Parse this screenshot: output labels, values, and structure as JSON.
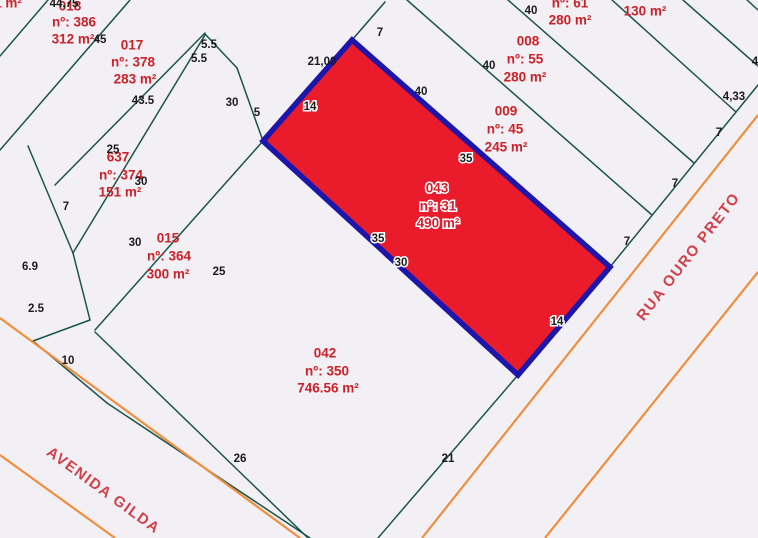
{
  "map": {
    "width": 758,
    "height": 538,
    "background": "#f2eff5",
    "colors": {
      "boundary_green": "#1a5547",
      "street_orange": "#ef8f3d",
      "highlight_fill": "#ea1c2c",
      "highlight_border": "#1c16aa",
      "parcel_label_red": "#cc2127",
      "street_name_red": "#d23f48",
      "dimension_black": "#1b1b1b",
      "halo_white": "#ffffff"
    },
    "highlight_parcel": {
      "id": "043",
      "numero": "nº: 31",
      "area": "490 m²",
      "vertices": "352,40 610,267 518,375 263,141",
      "labels": [
        {
          "text": "043",
          "x": 437,
          "y": 189
        },
        {
          "text": "nº: 31",
          "x": 438,
          "y": 207
        },
        {
          "text": "490 m²",
          "x": 438,
          "y": 224
        }
      ]
    },
    "parcels": [
      {
        "name": "parcel-018",
        "lines": [
          {
            "text": "018",
            "x": 70,
            "y": 7
          },
          {
            "text": "nº: 386",
            "x": 74,
            "y": 23
          },
          {
            "text": "312 m²",
            "x": 73,
            "y": 40
          }
        ]
      },
      {
        "name": "parcel-017",
        "lines": [
          {
            "text": "017",
            "x": 132,
            "y": 46
          },
          {
            "text": "nº: 378",
            "x": 133,
            "y": 63
          },
          {
            "text": "283 m²",
            "x": 135,
            "y": 80
          }
        ]
      },
      {
        "name": "parcel-637",
        "lines": [
          {
            "text": "637",
            "x": 118,
            "y": 158
          },
          {
            "text": "nº: 374",
            "x": 121,
            "y": 176
          },
          {
            "text": "151 m²",
            "x": 120,
            "y": 193
          }
        ]
      },
      {
        "name": "parcel-015",
        "lines": [
          {
            "text": "015",
            "x": 168,
            "y": 239
          },
          {
            "text": "nº: 364",
            "x": 169,
            "y": 257
          },
          {
            "text": "300 m²",
            "x": 168,
            "y": 275
          }
        ]
      },
      {
        "name": "parcel-042",
        "lines": [
          {
            "text": "042",
            "x": 325,
            "y": 354
          },
          {
            "text": "nº: 350",
            "x": 327,
            "y": 372
          },
          {
            "text": "746.56 m²",
            "x": 328,
            "y": 389
          }
        ]
      },
      {
        "name": "parcel-008",
        "lines": [
          {
            "text": "008",
            "x": 528,
            "y": 42
          },
          {
            "text": "nº: 55",
            "x": 525,
            "y": 60
          },
          {
            "text": "280 m²",
            "x": 525,
            "y": 78
          }
        ]
      },
      {
        "name": "parcel-009",
        "lines": [
          {
            "text": "009",
            "x": 506,
            "y": 112
          },
          {
            "text": "nº: 45",
            "x": 505,
            "y": 130
          },
          {
            "text": "245 m²",
            "x": 506,
            "y": 148
          }
        ]
      },
      {
        "name": "parcel-61",
        "lines": [
          {
            "text": "nº: 61",
            "x": 570,
            "y": 4
          },
          {
            "text": "280 m²",
            "x": 570,
            "y": 21
          }
        ]
      },
      {
        "name": "parcel-130",
        "lines": [
          {
            "text": "130 m²",
            "x": 645,
            "y": 12
          }
        ]
      },
      {
        "name": "parcel-edge-partial",
        "lines": [
          {
            "text": "1 m²",
            "x": 8,
            "y": 4
          }
        ]
      }
    ],
    "dimensions": [
      {
        "text": "44,75",
        "x": 64,
        "y": 4
      },
      {
        "text": "45",
        "x": 100,
        "y": 40
      },
      {
        "text": "5.5",
        "x": 209,
        "y": 45
      },
      {
        "text": "5.5",
        "x": 199,
        "y": 59
      },
      {
        "text": "43.5",
        "x": 143,
        "y": 101
      },
      {
        "text": "30",
        "x": 232,
        "y": 103
      },
      {
        "text": "5",
        "x": 257,
        "y": 113
      },
      {
        "text": "25",
        "x": 113,
        "y": 150
      },
      {
        "text": "30",
        "x": 141,
        "y": 182
      },
      {
        "text": "7",
        "x": 66,
        "y": 207
      },
      {
        "text": "30",
        "x": 135,
        "y": 243
      },
      {
        "text": "25",
        "x": 219,
        "y": 272
      },
      {
        "text": "6.9",
        "x": 30,
        "y": 267
      },
      {
        "text": "2.5",
        "x": 36,
        "y": 309
      },
      {
        "text": "10",
        "x": 68,
        "y": 361
      },
      {
        "text": "26",
        "x": 240,
        "y": 459
      },
      {
        "text": "21",
        "x": 448,
        "y": 459
      },
      {
        "text": "21,00",
        "x": 322,
        "y": 62
      },
      {
        "text": "7",
        "x": 380,
        "y": 33
      },
      {
        "text": "40",
        "x": 421,
        "y": 92
      },
      {
        "text": "40",
        "x": 489,
        "y": 66
      },
      {
        "text": "40",
        "x": 531,
        "y": 11
      },
      {
        "text": "7",
        "x": 627,
        "y": 242
      },
      {
        "text": "7",
        "x": 675,
        "y": 184
      },
      {
        "text": "7",
        "x": 719,
        "y": 133
      },
      {
        "text": "4,33",
        "x": 734,
        "y": 97
      },
      {
        "text": "4",
        "x": 755,
        "y": 62
      },
      {
        "text": "14",
        "x": 310,
        "y": 107,
        "halo": true
      },
      {
        "text": "35",
        "x": 466,
        "y": 159,
        "halo": true
      },
      {
        "text": "35",
        "x": 378,
        "y": 239,
        "halo": true
      },
      {
        "text": "30",
        "x": 401,
        "y": 263,
        "halo": true
      },
      {
        "text": "14",
        "x": 557,
        "y": 322,
        "halo": true
      }
    ],
    "streets": [
      {
        "name": "AVENIDA GILDA",
        "x": 103,
        "y": 491,
        "angle": 36
      },
      {
        "name": "RUA OURO PRETO",
        "x": 689,
        "y": 257,
        "angle": -52
      }
    ],
    "boundary_lines": [
      [
        0,
        56,
        48,
        0
      ],
      [
        0,
        150,
        130,
        0
      ],
      [
        55,
        185,
        205,
        33
      ],
      [
        73,
        253,
        205,
        35
      ],
      [
        95,
        330,
        263,
        141
      ],
      [
        28,
        146,
        73,
        253
      ],
      [
        73,
        253,
        90,
        320
      ],
      [
        90,
        320,
        33,
        341
      ],
      [
        205,
        34,
        237,
        68
      ],
      [
        237,
        68,
        263,
        141
      ],
      [
        33,
        341,
        107,
        403
      ],
      [
        107,
        403,
        310,
        538
      ],
      [
        95,
        332,
        308,
        538
      ],
      [
        518,
        375,
        378,
        538
      ],
      [
        610,
        267,
        758,
        85
      ],
      [
        407,
        0,
        652,
        215
      ],
      [
        508,
        0,
        694,
        163
      ],
      [
        612,
        0,
        736,
        112
      ],
      [
        683,
        0,
        758,
        66
      ],
      [
        747,
        0,
        758,
        10
      ],
      [
        385,
        2,
        352,
        40
      ]
    ],
    "street_lines": [
      [
        0,
        318,
        300,
        538
      ],
      [
        0,
        455,
        115,
        538
      ],
      [
        422,
        538,
        758,
        115
      ],
      [
        545,
        538,
        758,
        272
      ]
    ]
  }
}
